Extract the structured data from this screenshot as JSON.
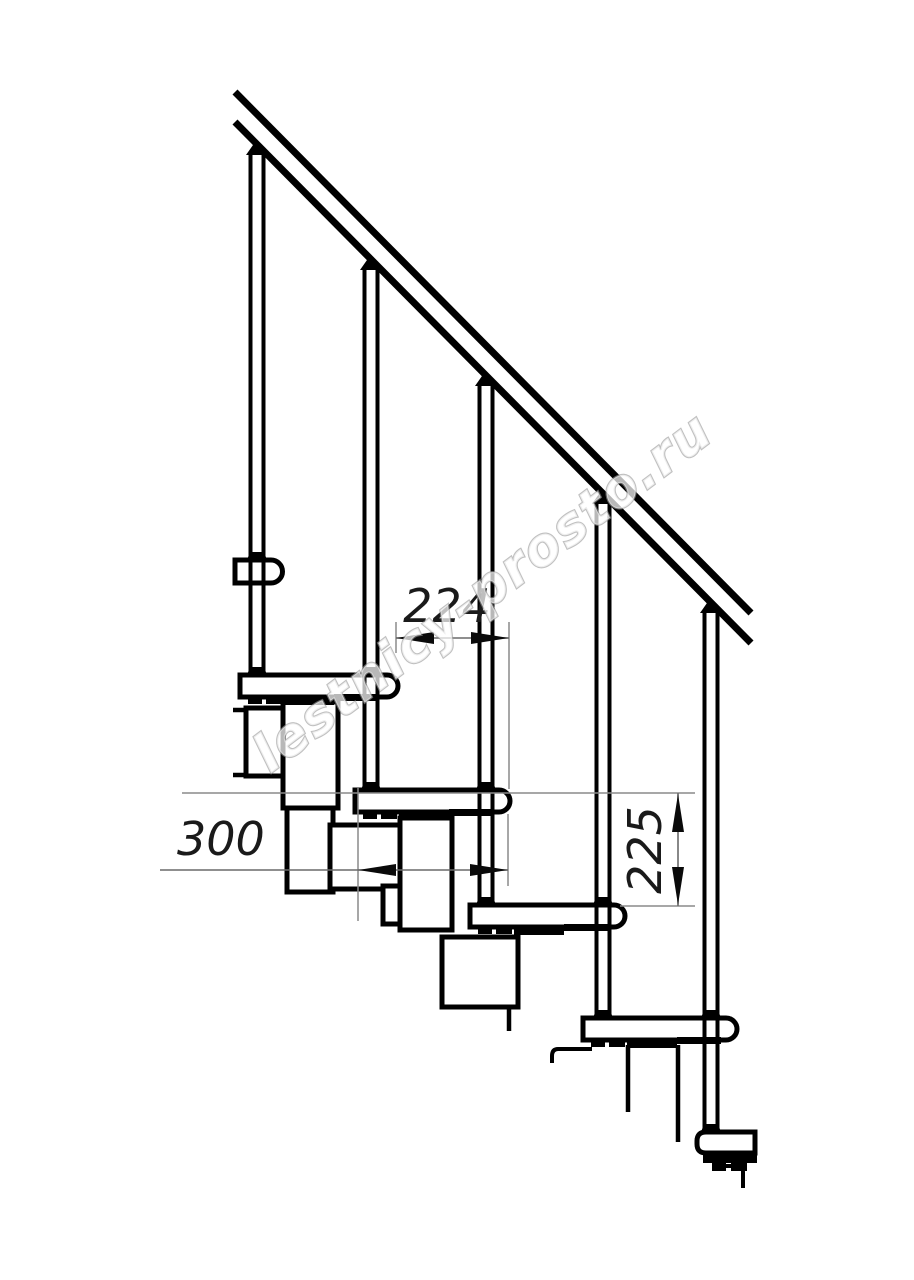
{
  "dimensions": {
    "tread_run": "224",
    "module_depth": "300",
    "step_rise": "225"
  },
  "watermark": {
    "text": "lestnicy-prosto.ru"
  },
  "colors": {
    "line": "#000000",
    "dimension_line": "#6a6a6a",
    "extension_line": "#8a8a8a",
    "watermark_outline": "#999999",
    "background": "#ffffff"
  }
}
